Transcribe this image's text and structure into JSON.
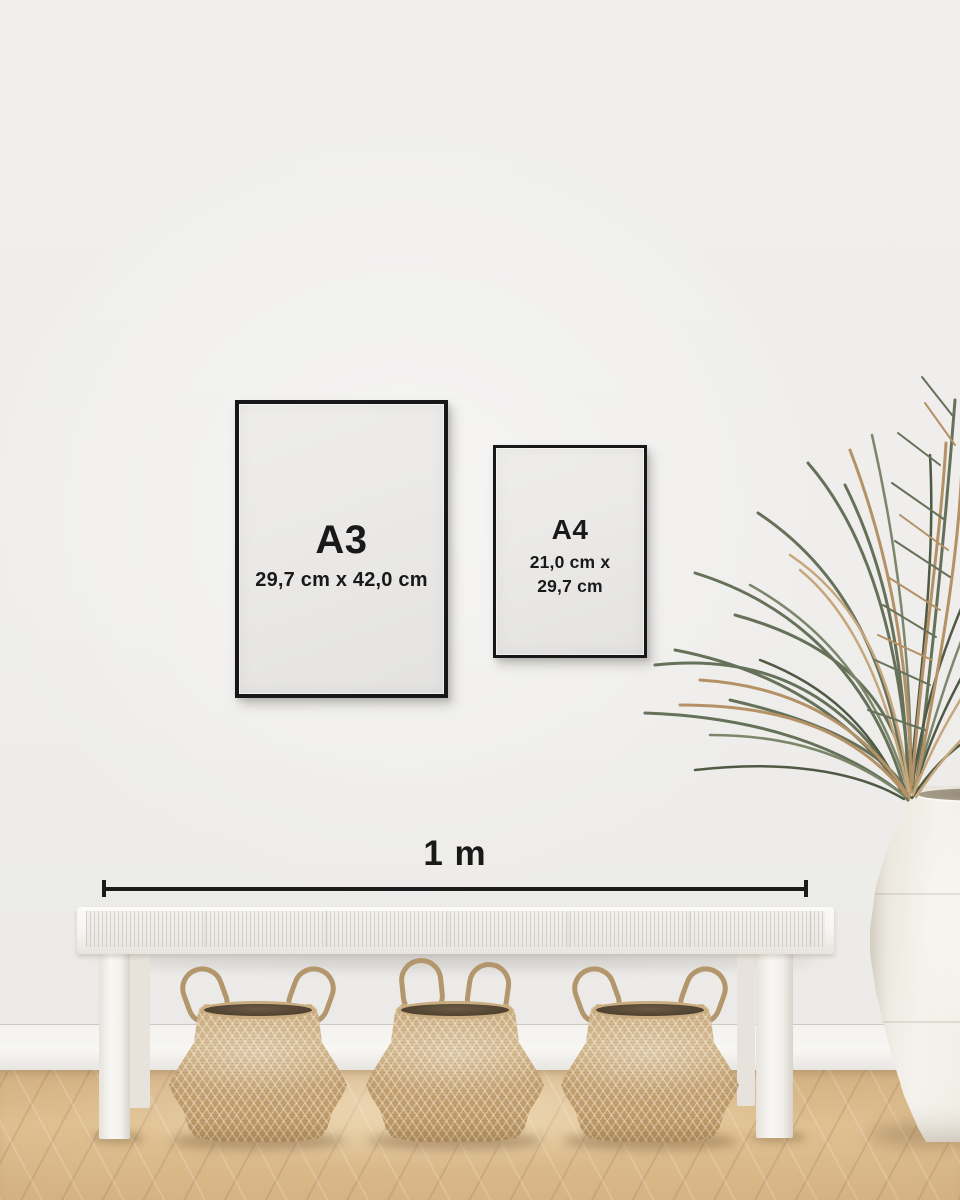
{
  "frames": [
    {
      "label": "A3",
      "dimensions": "29,7 cm x 42,0 cm"
    },
    {
      "label": "A4",
      "dimensions_line1": "21,0 cm x",
      "dimensions_line2": "29,7 cm"
    }
  ],
  "scale": {
    "label": "1 m"
  },
  "colors": {
    "wall": "#efeeec",
    "baseboard": "#f6f5f2",
    "floor_wood": "#d9b886",
    "frame_black": "#17171a",
    "poster_paper": "#e9e8e6",
    "text": "#191919",
    "measure_line": "#1c1c1c",
    "bench_white": "#f5f4f1",
    "basket_seagrass": "#c7a878",
    "basket_interior": "#4e4030",
    "vase_ceramic": "#f2f0ea",
    "plant_green": "#66715a",
    "plant_tan": "#b59166"
  }
}
